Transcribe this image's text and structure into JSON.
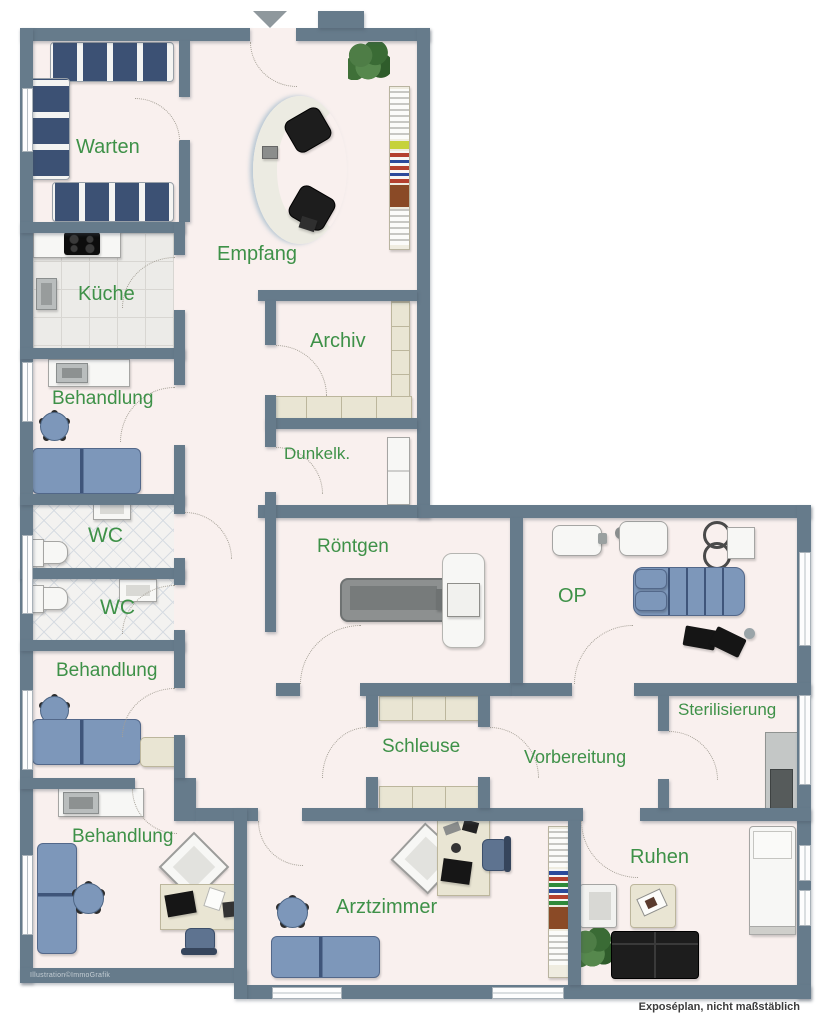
{
  "annotations": {
    "credit": "Illustration©ImmoGrafik",
    "disclaimer": "Exposéplan, nicht maßstäblich"
  },
  "palette": {
    "wall": "#667B8B",
    "floor": "#F9F0EE",
    "room_label_green": "#3E9148",
    "furniture_blue": "#7D97BA",
    "seat_navy": "#3C5174",
    "cabinet_beige": "#E9E5D3",
    "background": "#FFFFFF"
  },
  "rooms": {
    "warten": {
      "label": "Warten"
    },
    "kueche": {
      "label": "Küche"
    },
    "empfang": {
      "label": "Empfang"
    },
    "archiv": {
      "label": "Archiv"
    },
    "dunkelkammer": {
      "label": "Dunkelk."
    },
    "behandlung1": {
      "label": "Behandlung"
    },
    "wc1": {
      "label": "WC"
    },
    "wc2": {
      "label": "WC"
    },
    "behandlung2": {
      "label": "Behandlung"
    },
    "roentgen": {
      "label": "Röntgen"
    },
    "op": {
      "label": "OP"
    },
    "schleuse": {
      "label": "Schleuse"
    },
    "vorbereitung": {
      "label": "Vorbereitung"
    },
    "sterilisierung": {
      "label": "Sterilisierung"
    },
    "behandlung3": {
      "label": "Behandlung"
    },
    "arztzimmer": {
      "label": "Arztzimmer"
    },
    "ruhen": {
      "label": "Ruhen"
    }
  }
}
